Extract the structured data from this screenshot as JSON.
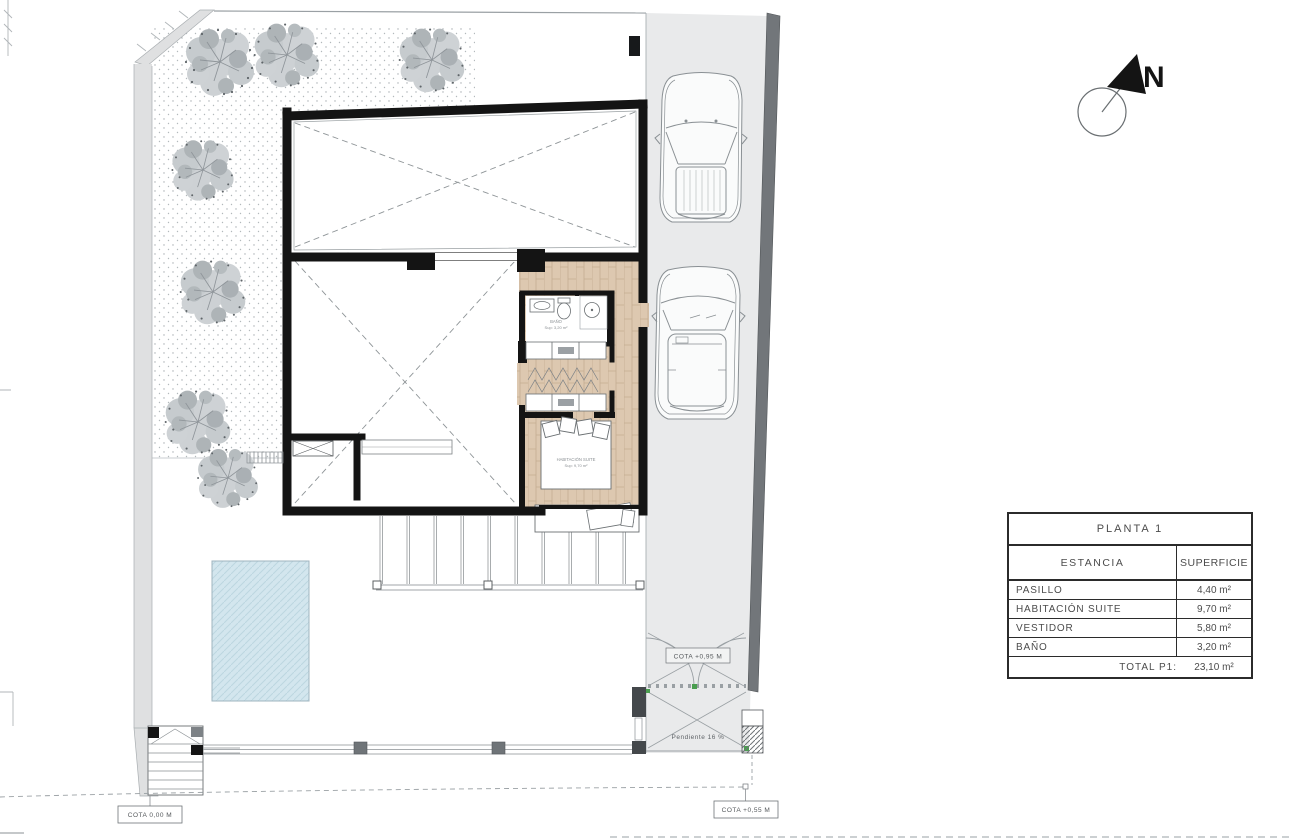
{
  "compass": {
    "label": "N"
  },
  "table": {
    "title": "PLANTA 1",
    "col_room": "ESTANCIA",
    "col_area": "SUPERFICIE",
    "rows": [
      {
        "name": "PASILLO",
        "area": "4,40 m²"
      },
      {
        "name": "HABITACIÓN SUITE",
        "area": "9,70 m²"
      },
      {
        "name": "VESTIDOR",
        "area": "5,80 m²"
      },
      {
        "name": "BAÑO",
        "area": "3,20 m²"
      }
    ],
    "total_label": "TOTAL P1:",
    "total_area": "23,10 m²"
  },
  "annotations": {
    "cota_ground": "COTA 0,00 M",
    "cota_gate": "COTA +0,95 M",
    "cota_street": "COTA +0,55 M",
    "slope": "Pendiente 16 %"
  },
  "room_labels": {
    "bath_name": "BAÑO",
    "bath_area": "Sup: 3,20 m²",
    "suite_name": "HABITACIÓN SUITE",
    "suite_area": "Sup: 9,70 m²"
  },
  "colors": {
    "wall": "#141414",
    "wood_floor": "#ddc8b0",
    "pool": "#d3e6ee",
    "driveway": "#e9eaeb",
    "boundary_wall": "#72767a",
    "tree_light": "#cdd1d4",
    "tree_dark": "#aab0b4",
    "marker_green": "#4a9e4f"
  }
}
